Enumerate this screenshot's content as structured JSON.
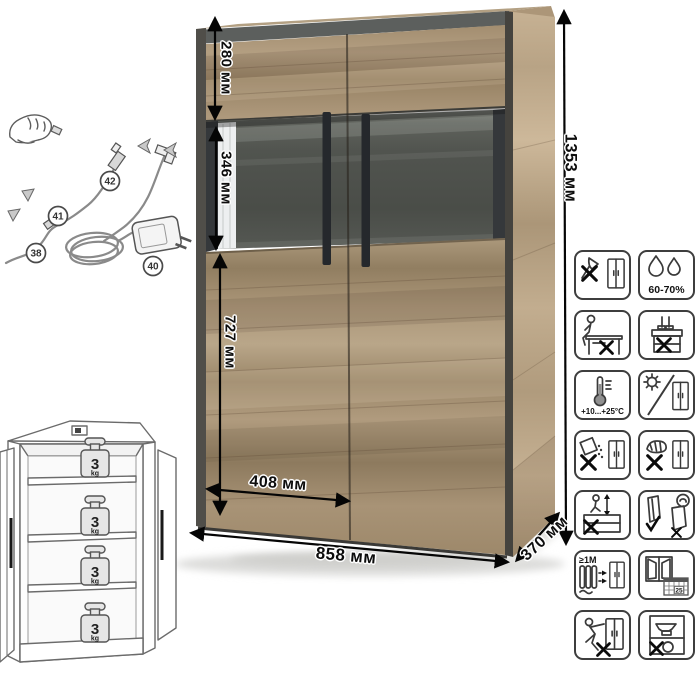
{
  "diagram_title": "cabinet-technical-diagram",
  "dimensions": {
    "total_height": "1353 мм",
    "upper_section_height": "280 мм",
    "glass_section_height": "346 мм",
    "lower_section_height": "727 мм",
    "door_width": "408 мм",
    "total_width": "858 мм",
    "depth": "370 мм"
  },
  "wiring": {
    "part_labels": [
      "38",
      "40",
      "41",
      "42"
    ]
  },
  "shelf_load": {
    "items": [
      {
        "value": "3",
        "unit": "kg"
      },
      {
        "value": "3",
        "unit": "kg"
      },
      {
        "value": "3",
        "unit": "kg"
      },
      {
        "value": "3",
        "unit": "kg"
      }
    ]
  },
  "care_icons": [
    {
      "name": "no-sharp-tools",
      "label": ""
    },
    {
      "name": "humidity-range",
      "label": "60-70%"
    },
    {
      "name": "no-sitting",
      "label": ""
    },
    {
      "name": "no-standing",
      "label": ""
    },
    {
      "name": "temperature-range",
      "label": "+10...+25°C"
    },
    {
      "name": "no-direct-sunlight",
      "label": ""
    },
    {
      "name": "no-aggressive-liquids",
      "label": ""
    },
    {
      "name": "no-abrasive-cleaning",
      "label": ""
    },
    {
      "name": "no-climbing",
      "label": ""
    },
    {
      "name": "transport-upright",
      "label": ""
    },
    {
      "name": "heat-source-distance",
      "label": "≥1M"
    },
    {
      "name": "ventilate-room",
      "label": "25"
    },
    {
      "name": "no-dragging",
      "label": ""
    },
    {
      "name": "no-overloading",
      "label": ""
    }
  ],
  "colors": {
    "wood": "#ab9678",
    "dark_trim": "#504e49",
    "glass_back": "#4d504b",
    "line_black": "#0d0d0d"
  }
}
